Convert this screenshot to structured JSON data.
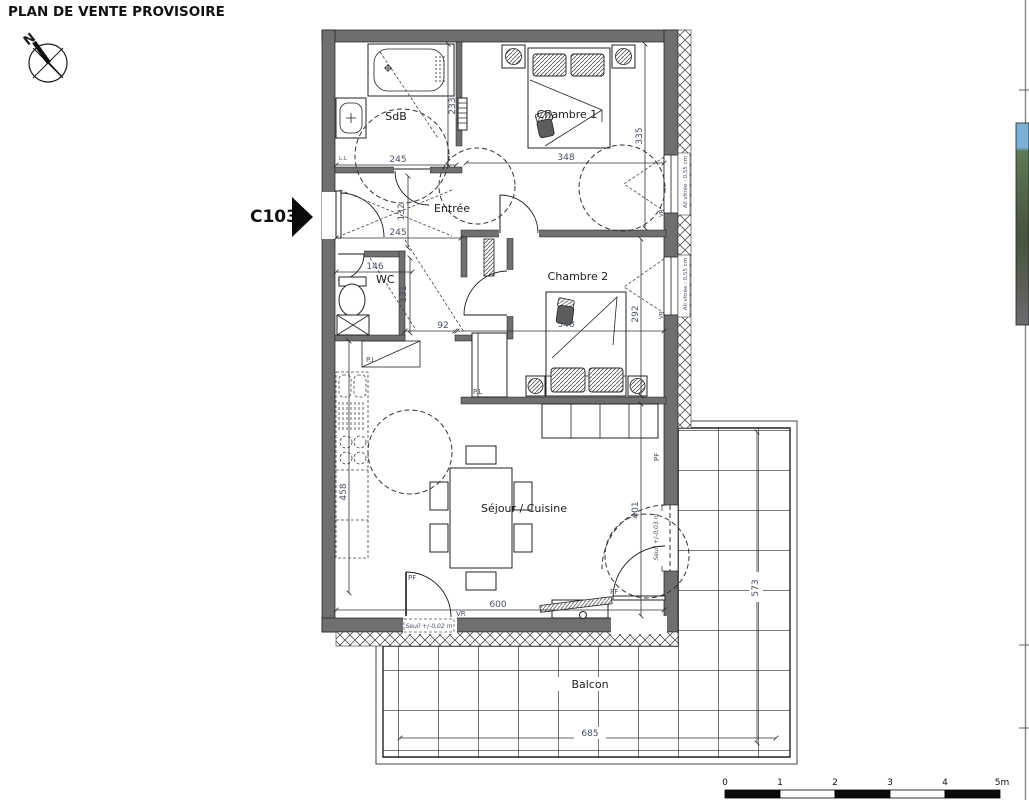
{
  "page": {
    "title": "PLAN DE VENTE PROVISOIRE"
  },
  "compass": {
    "north": "N"
  },
  "unit": {
    "code": "C103"
  },
  "rooms": {
    "sdb": {
      "name": "SdB",
      "width": "245",
      "depth": "233"
    },
    "chambre1": {
      "name": "Chambre 1",
      "width": "348",
      "depth": "335"
    },
    "entree": {
      "name": "Entrée",
      "width": "245",
      "depth": "132"
    },
    "wc": {
      "name": "WC",
      "width": "146",
      "depth": "131"
    },
    "hall": {
      "passage": "92"
    },
    "chambre2": {
      "name": "Chambre 2",
      "width": "348",
      "depth": "292"
    },
    "sejour": {
      "name": "Séjour / Cuisine",
      "width": "600",
      "depth": "401",
      "kitchen": "458"
    },
    "balcon": {
      "name": "Balcon",
      "width": "685",
      "depth": "573"
    }
  },
  "labels": {
    "allege": "All vitrée : 0,55 cm",
    "seuil_bas": "Seuil +/-0,02 m",
    "seuil_droit": "Seuil +/-0,03 m",
    "vr": "VR",
    "pf": "PF",
    "pl": "P.L",
    "ll": "L.L"
  },
  "scale_bar": {
    "ticks": [
      "0",
      "1",
      "2",
      "3",
      "4",
      "5m"
    ]
  }
}
